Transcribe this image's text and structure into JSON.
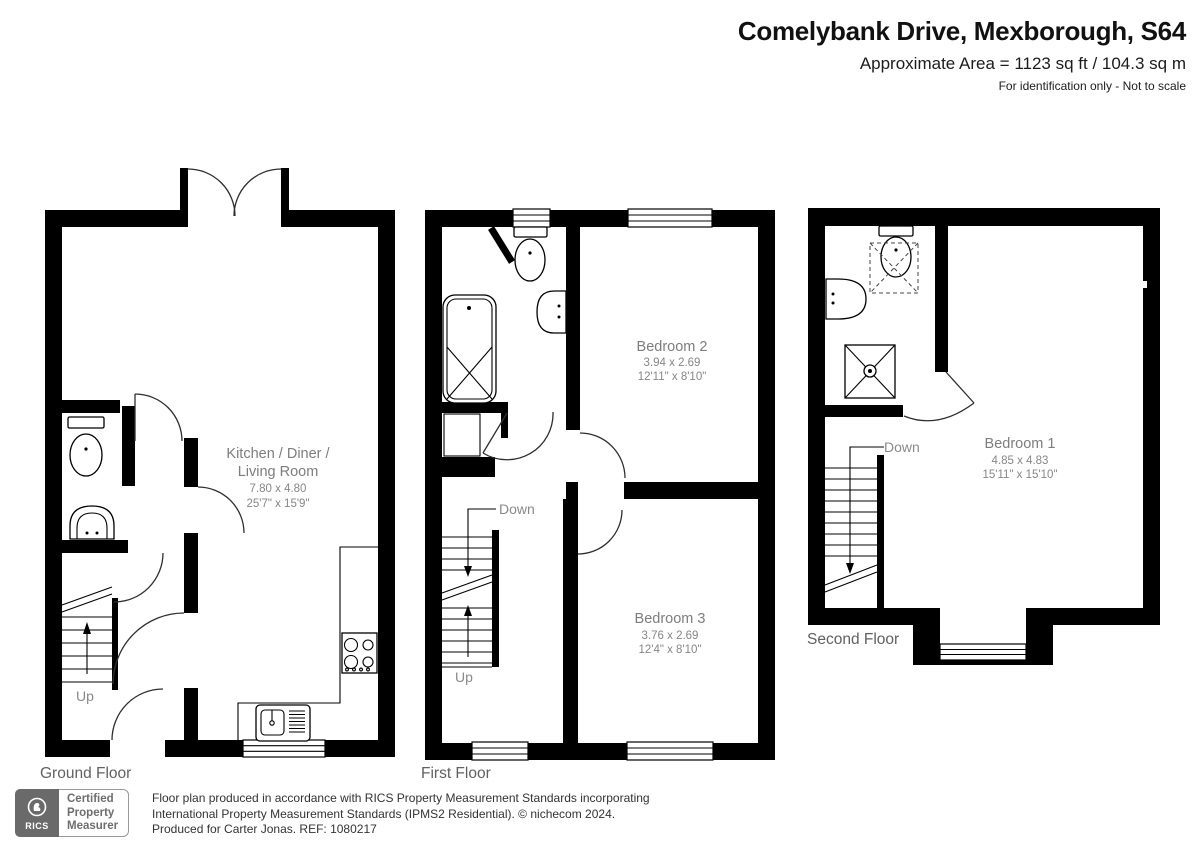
{
  "header": {
    "title": "Comelybank Drive, Mexborough, S64",
    "area_line": "Approximate Area = 1123 sq ft / 104.3 sq m",
    "disclaimer": "For identification only - Not to scale"
  },
  "floors": {
    "ground": {
      "label": "Ground Floor",
      "room": {
        "name_line1": "Kitchen / Diner /",
        "name_line2": "Living Room",
        "dims_metric": "7.80 x 4.80",
        "dims_imperial": "25'7\" x 15'9\""
      },
      "stairs": {
        "up_label": "Up"
      }
    },
    "first": {
      "label": "First Floor",
      "bedroom2": {
        "name": "Bedroom 2",
        "dims_metric": "3.94 x 2.69",
        "dims_imperial": "12'11\" x 8'10\""
      },
      "bedroom3": {
        "name": "Bedroom 3",
        "dims_metric": "3.76 x 2.69",
        "dims_imperial": "12'4\" x 8'10\""
      },
      "stairs": {
        "down_label": "Down",
        "up_label": "Up"
      }
    },
    "second": {
      "label": "Second Floor",
      "bedroom1": {
        "name": "Bedroom 1",
        "dims_metric": "4.85 x 4.83",
        "dims_imperial": "15'11\" x 15'10\""
      },
      "stairs": {
        "down_label": "Down"
      }
    }
  },
  "footer": {
    "badge": {
      "org": "RICS",
      "line1": "Certified",
      "line2": "Property",
      "line3": "Measurer"
    },
    "line1": "Floor plan produced in accordance with RICS Property Measurement Standards incorporating",
    "line2": "International Property Measurement Standards (IPMS2 Residential).  © nichecom 2024.",
    "line3": "Produced for Carter Jonas.   REF:  1080217"
  },
  "colors": {
    "wall": "#000000",
    "label_gray": "#7d7d7d"
  }
}
